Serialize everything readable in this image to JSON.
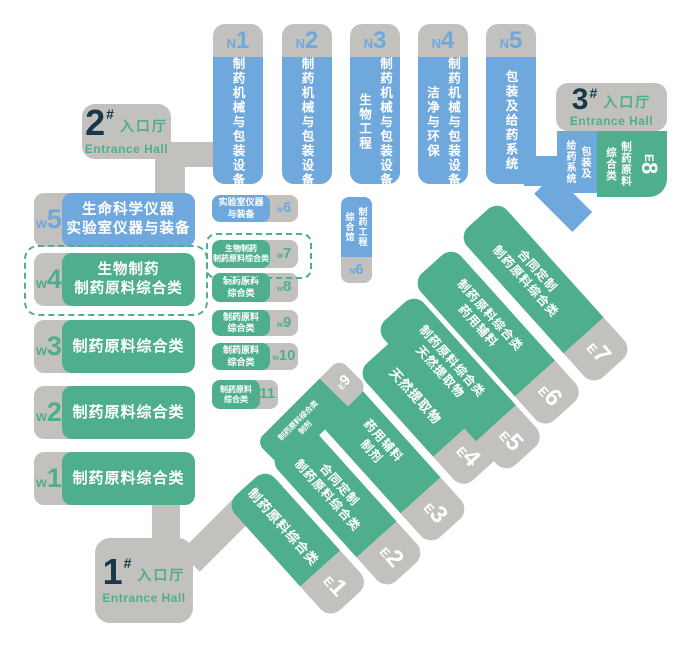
{
  "colors": {
    "blue": "#6FA8DC",
    "green": "#4FAF8C",
    "gray": "#C2C1BD",
    "navy": "#16384A",
    "white": "#FFFFFF"
  },
  "entrances": {
    "hall1": {
      "number": "1",
      "hash": "#",
      "cn": "入口厅",
      "en": "Entrance Hall"
    },
    "hall2": {
      "number": "2",
      "hash": "#",
      "cn": "入口厅",
      "en": "Entrance Hall"
    },
    "hall3": {
      "number": "3",
      "hash": "#",
      "cn": "入口厅",
      "en": "Entrance Hall"
    }
  },
  "north_halls": [
    {
      "letter": "N",
      "number": "1",
      "lines": [
        "制药机械与包装设备"
      ]
    },
    {
      "letter": "N",
      "number": "2",
      "lines": [
        "制药机械与包装设备"
      ]
    },
    {
      "letter": "N",
      "number": "3",
      "lines": [
        "制药机械与包装设备",
        "生物工程"
      ]
    },
    {
      "letter": "N",
      "number": "4",
      "lines": [
        "制药机械与包装设备",
        "洁净与环保"
      ]
    },
    {
      "letter": "N",
      "number": "5",
      "lines": [
        "包装及给药系统"
      ]
    }
  ],
  "n6": {
    "letter": "N",
    "number": "6",
    "lines": [
      "制药工程",
      "综合馆"
    ]
  },
  "west_halls": [
    {
      "letter": "w",
      "number": "5",
      "lines": [
        "生命科学仪器",
        "实验室仪器与装备"
      ]
    },
    {
      "letter": "w",
      "number": "4",
      "lines": [
        "生物制药",
        "制药原料综合类"
      ]
    },
    {
      "letter": "w",
      "number": "3",
      "lines": [
        "制药原料综合类"
      ]
    },
    {
      "letter": "w",
      "number": "2",
      "lines": [
        "制药原料综合类"
      ]
    },
    {
      "letter": "w",
      "number": "1",
      "lines": [
        "制药原料综合类"
      ]
    }
  ],
  "west_small_halls": [
    {
      "letter": "w",
      "number": "6",
      "lines": [
        "实验室仪器",
        "与装备"
      ]
    },
    {
      "letter": "w",
      "number": "7",
      "lines": [
        "生物制药",
        "制药原料综合类"
      ]
    },
    {
      "letter": "w",
      "number": "8",
      "lines": [
        "制药原料",
        "综合类"
      ]
    },
    {
      "letter": "w",
      "number": "9",
      "lines": [
        "制药原料",
        "综合类"
      ]
    },
    {
      "letter": "w",
      "number": "10",
      "lines": [
        "制药原料",
        "综合类"
      ]
    },
    {
      "letter": "w",
      "number": "11",
      "lines": [
        "制药原料",
        "综合类"
      ]
    }
  ],
  "east_halls": [
    {
      "letter": "E",
      "number": "1",
      "lines": [
        "制药原料综合类"
      ]
    },
    {
      "letter": "E",
      "number": "2",
      "lines": [
        "合同定制",
        "制药原料综合类"
      ]
    },
    {
      "letter": "E",
      "number": "3",
      "lines": [
        "药用辅料",
        "制剂"
      ]
    },
    {
      "letter": "E",
      "number": "4",
      "lines": [
        "天然提取物"
      ]
    },
    {
      "letter": "E",
      "number": "5",
      "lines": [
        "制药原料综合类",
        "天然提取物"
      ]
    },
    {
      "letter": "E",
      "number": "6",
      "lines": [
        "制药原料综合类",
        "药用辅料"
      ]
    },
    {
      "letter": "E",
      "number": "7",
      "lines": [
        "合同定制",
        "制药原料综合类"
      ]
    }
  ],
  "e8": {
    "letter": "E",
    "number": "8",
    "lines": [
      "制药原料",
      "综合类"
    ]
  },
  "e9": {
    "letter": "E",
    "number": "9",
    "lines": [
      "制药原料综合类",
      "制剂"
    ]
  },
  "n5_tab": {
    "lines": [
      "包装及",
      "给药系统"
    ]
  }
}
